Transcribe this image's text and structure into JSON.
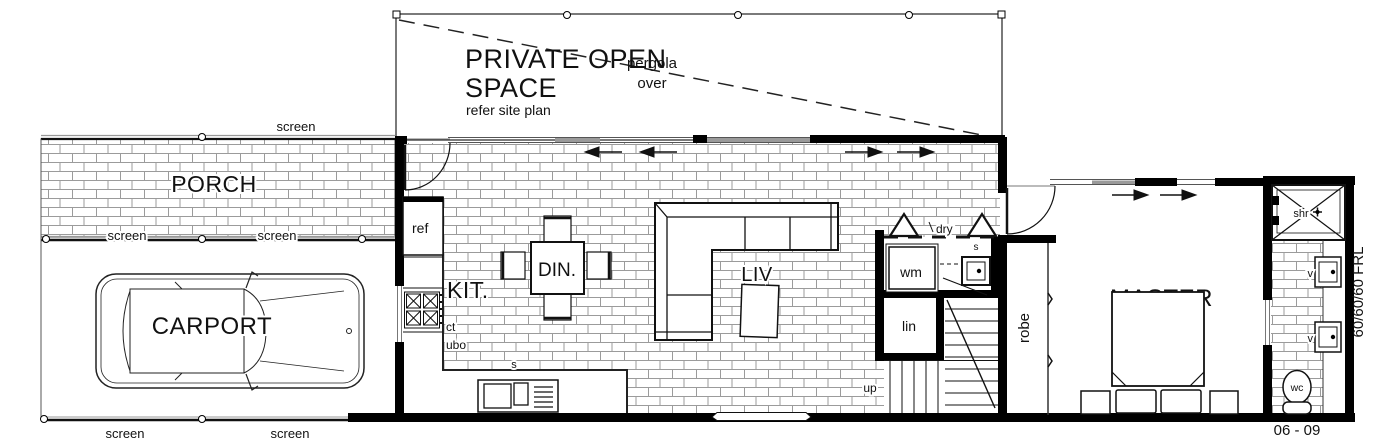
{
  "plan": {
    "outdoor": {
      "private_open_space_line1": "PRIVATE OPEN",
      "private_open_space_line2": "SPACE",
      "private_open_space_note": "refer site plan",
      "pergola_line1": "pergola",
      "pergola_line2": "over",
      "porch_label": "PORCH",
      "carport_label": "CARPORT",
      "screen_label": "screen"
    },
    "rooms": {
      "kitchen_label": "KIT.",
      "dining_label": "DIN.",
      "living_label": "LIV",
      "master_line1": "MASTER",
      "master_line2": "BED",
      "robe_label": "robe",
      "linen_label": "lin",
      "stairs_up_label": "up"
    },
    "fixtures": {
      "fridge": "ref",
      "cooktop": "ct",
      "under_bench_oven": "ubo",
      "kitchen_sink": "s",
      "washing_machine": "wm",
      "dryer": "dry",
      "laundry_trough": "s",
      "shower": "shr",
      "vanity": "v",
      "toilet": "wc"
    },
    "annotations": {
      "fire_rating": "60/60/60 FRL",
      "sheet_ref": "06 - 09"
    },
    "colors": {
      "background": "#ffffff",
      "wall": "#000000",
      "brick_line": "#9b9b9b",
      "glass_panel": "#9a9a9a",
      "line": "#111111"
    }
  }
}
